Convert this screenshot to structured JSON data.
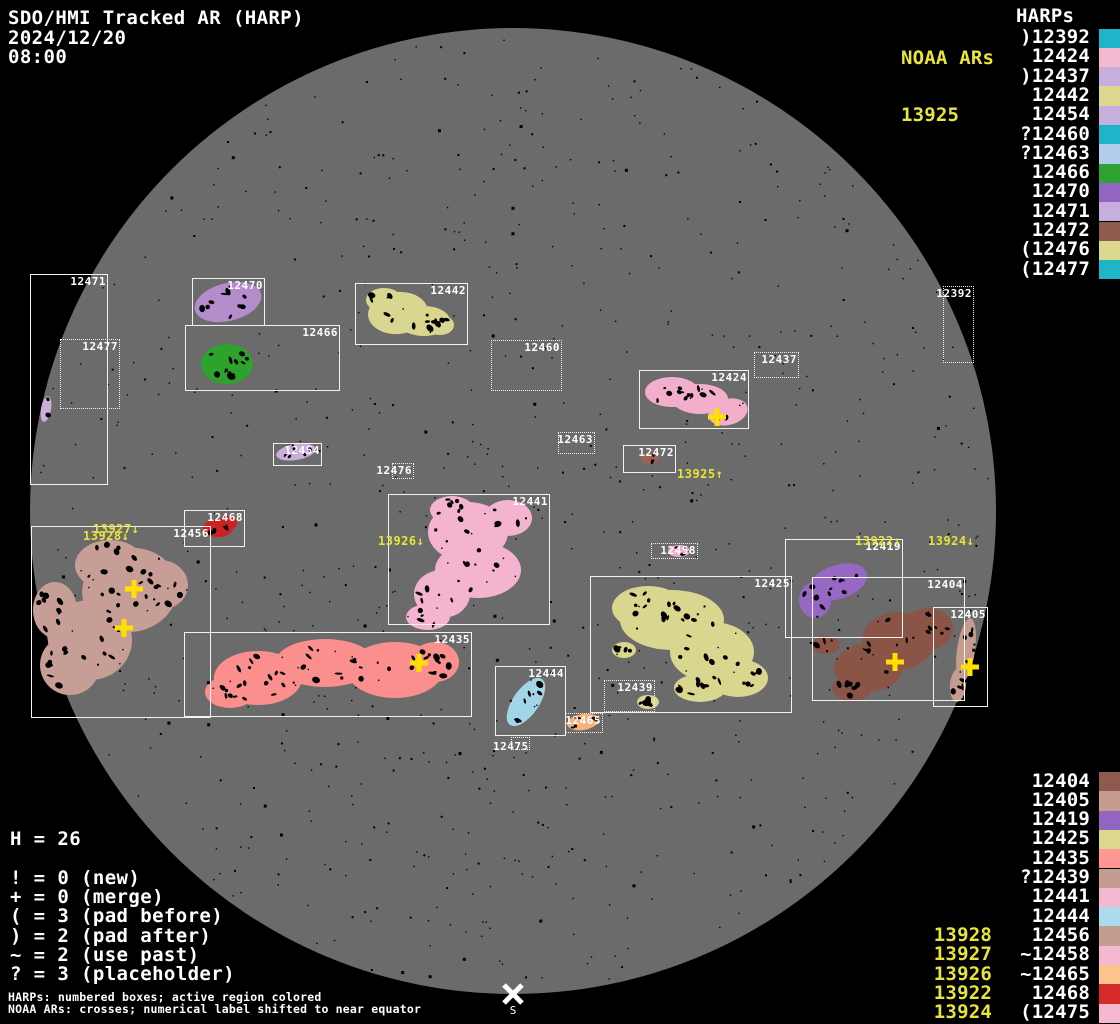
{
  "header": {
    "title": "SDO/HMI Tracked AR (HARP)",
    "date": "2024/12/20",
    "time": "08:00"
  },
  "colors": {
    "background": "#000000",
    "disk": "#6b6b6b",
    "box_border": "#f2f2f2",
    "label_white": "#ffffff",
    "noaa_yellow": "#e8e43a",
    "cross_yellow": "#ffe000"
  },
  "noaa_panel": {
    "title": "NOAA ARs",
    "value": "13925"
  },
  "harps_panel": {
    "title": "HARPs",
    "items": [
      {
        "prefix": ")",
        "num": "12392",
        "color": "#1fb5c9"
      },
      {
        "prefix": " ",
        "num": "12424",
        "color": "#f5b8d2"
      },
      {
        "prefix": ")",
        "num": "12437",
        "color": "#c6aedd"
      },
      {
        "prefix": " ",
        "num": "12442",
        "color": "#dcd98e"
      },
      {
        "prefix": " ",
        "num": "12454",
        "color": "#c6aedd"
      },
      {
        "prefix": "?",
        "num": "12460",
        "color": "#1fb5c9"
      },
      {
        "prefix": "?",
        "num": "12463",
        "color": "#b4cdec"
      },
      {
        "prefix": " ",
        "num": "12466",
        "color": "#2fa233"
      },
      {
        "prefix": " ",
        "num": "12470",
        "color": "#9266c0"
      },
      {
        "prefix": " ",
        "num": "12471",
        "color": "#c6aedd"
      },
      {
        "prefix": " ",
        "num": "12472",
        "color": "#8f5a4e"
      },
      {
        "prefix": "(",
        "num": "12476",
        "color": "#dcd98e"
      },
      {
        "prefix": "(",
        "num": "12477",
        "color": "#1fb5c9"
      }
    ]
  },
  "bottom_right_panel": {
    "items": [
      {
        "prefix": " ",
        "num": "12404",
        "color": "#8f5a4e",
        "noaa": ""
      },
      {
        "prefix": " ",
        "num": "12405",
        "color": "#c49c90",
        "noaa": ""
      },
      {
        "prefix": " ",
        "num": "12419",
        "color": "#9266c0",
        "noaa": ""
      },
      {
        "prefix": " ",
        "num": "12425",
        "color": "#dcd98e",
        "noaa": ""
      },
      {
        "prefix": " ",
        "num": "12435",
        "color": "#ff9694",
        "noaa": ""
      },
      {
        "prefix": "?",
        "num": "12439",
        "color": "#c49c90",
        "noaa": ""
      },
      {
        "prefix": " ",
        "num": "12441",
        "color": "#f5b8d2",
        "noaa": ""
      },
      {
        "prefix": " ",
        "num": "12444",
        "color": "#aadced",
        "noaa": ""
      },
      {
        "prefix": " ",
        "num": "12456",
        "color": "#c49c90",
        "noaa": "13928"
      },
      {
        "prefix": "~",
        "num": "12458",
        "color": "#f5b8d2",
        "noaa": "13927"
      },
      {
        "prefix": "~",
        "num": "12465",
        "color": "#fdc38b",
        "noaa": "13926"
      },
      {
        "prefix": " ",
        "num": "12468",
        "color": "#d42b28",
        "noaa": "13922"
      },
      {
        "prefix": "(",
        "num": "12475",
        "color": "#f5b8d2",
        "noaa": "13924"
      }
    ]
  },
  "stats": {
    "h_line": "H = 26",
    "legend": [
      "! = 0 (new)",
      "+ = 0 (merge)",
      "( = 3 (pad before)",
      ") = 2 (pad after)",
      "~ = 2 (use past)",
      "? = 3 (placeholder)"
    ]
  },
  "footer": {
    "line1": "HARPs: numbered boxes; active region colored",
    "line2": "NOAA ARs: crosses; numerical label shifted to near equator"
  },
  "chart_data": {
    "type": "scatter",
    "title": "SDO/HMI Tracked AR (HARP) full-disk map, 2024/12/20 08:00",
    "disk": {
      "cx": 513,
      "cy": 511,
      "r": 483,
      "color": "#6b6b6b"
    },
    "south_marker": {
      "x": 513,
      "y": 994,
      "label": "S"
    },
    "harp_boxes": [
      {
        "id": "12471",
        "x": 30,
        "y": 274,
        "w": 78,
        "h": 211,
        "style": "solid",
        "anchor": "tr"
      },
      {
        "id": "12477",
        "x": 60,
        "y": 339,
        "w": 60,
        "h": 70,
        "style": "dotted",
        "anchor": "tr"
      },
      {
        "id": "12470",
        "x": 192,
        "y": 278,
        "w": 73,
        "h": 48,
        "style": "solid",
        "anchor": "tr"
      },
      {
        "id": "12466",
        "x": 185,
        "y": 325,
        "w": 155,
        "h": 66,
        "style": "solid",
        "anchor": "tr"
      },
      {
        "id": "12442",
        "x": 355,
        "y": 283,
        "w": 113,
        "h": 62,
        "style": "solid",
        "anchor": "tr"
      },
      {
        "id": "12460",
        "x": 491,
        "y": 340,
        "w": 71,
        "h": 51,
        "style": "dotted",
        "anchor": "tr"
      },
      {
        "id": "12437",
        "x": 754,
        "y": 352,
        "w": 45,
        "h": 26,
        "style": "dotted",
        "anchor": "tr"
      },
      {
        "id": "12424",
        "x": 639,
        "y": 370,
        "w": 110,
        "h": 59,
        "style": "solid",
        "anchor": "tr"
      },
      {
        "id": "12463",
        "x": 558,
        "y": 432,
        "w": 37,
        "h": 22,
        "style": "dotted",
        "anchor": "tr"
      },
      {
        "id": "12454",
        "x": 273,
        "y": 443,
        "w": 49,
        "h": 23,
        "style": "solid",
        "anchor": "tr"
      },
      {
        "id": "12472",
        "x": 623,
        "y": 445,
        "w": 53,
        "h": 28,
        "style": "solid",
        "anchor": "tr"
      },
      {
        "id": "12476",
        "x": 392,
        "y": 463,
        "w": 22,
        "h": 16,
        "style": "dotted",
        "anchor": "tr"
      },
      {
        "id": "12392",
        "x": 943,
        "y": 286,
        "w": 31,
        "h": 77,
        "style": "dotted",
        "anchor": "tr"
      },
      {
        "id": "12441",
        "x": 388,
        "y": 494,
        "w": 162,
        "h": 131,
        "style": "solid",
        "anchor": "tr"
      },
      {
        "id": "12456",
        "x": 31,
        "y": 526,
        "w": 180,
        "h": 192,
        "style": "solid",
        "anchor": "tr"
      },
      {
        "id": "12468",
        "x": 184,
        "y": 510,
        "w": 61,
        "h": 37,
        "style": "solid",
        "anchor": "tr"
      },
      {
        "id": "12458",
        "x": 651,
        "y": 543,
        "w": 47,
        "h": 16,
        "style": "dotted",
        "anchor": "tr"
      },
      {
        "id": "12419",
        "x": 785,
        "y": 539,
        "w": 118,
        "h": 99,
        "style": "solid",
        "anchor": "tr"
      },
      {
        "id": "12425",
        "x": 590,
        "y": 576,
        "w": 202,
        "h": 137,
        "style": "solid",
        "anchor": "tr"
      },
      {
        "id": "12404",
        "x": 812,
        "y": 577,
        "w": 153,
        "h": 124,
        "style": "solid",
        "anchor": "tr"
      },
      {
        "id": "12405",
        "x": 933,
        "y": 607,
        "w": 55,
        "h": 100,
        "style": "solid",
        "anchor": "tr"
      },
      {
        "id": "12435",
        "x": 184,
        "y": 632,
        "w": 288,
        "h": 85,
        "style": "solid",
        "anchor": "tr"
      },
      {
        "id": "12444",
        "x": 495,
        "y": 666,
        "w": 71,
        "h": 70,
        "style": "solid",
        "anchor": "tr"
      },
      {
        "id": "12439",
        "x": 604,
        "y": 680,
        "w": 51,
        "h": 32,
        "style": "dotted",
        "anchor": "tr"
      },
      {
        "id": "12465",
        "x": 565,
        "y": 713,
        "w": 38,
        "h": 20,
        "style": "dotted",
        "anchor": "tr"
      },
      {
        "id": "12475",
        "x": 511,
        "y": 737,
        "w": 19,
        "h": 13,
        "style": "dotted",
        "anchor": "bl"
      }
    ],
    "regions": [
      {
        "id": "12470",
        "color": "#b38dc9",
        "spots": 10,
        "ellipses": [
          [
            228,
            302,
            34,
            19,
            -14
          ]
        ]
      },
      {
        "id": "12466",
        "color": "#2da22d",
        "spots": 10,
        "ellipses": [
          [
            227,
            364,
            26,
            20,
            0
          ]
        ]
      },
      {
        "id": "12442",
        "color": "#d9d78f",
        "spots": 16,
        "ellipses": [
          [
            398,
            313,
            30,
            21,
            -5
          ],
          [
            424,
            321,
            26,
            15,
            0
          ],
          [
            384,
            300,
            18,
            12,
            0
          ],
          [
            440,
            325,
            14,
            10,
            0
          ]
        ]
      },
      {
        "id": "12424",
        "color": "#f2aecb",
        "spots": 14,
        "ellipses": [
          [
            672,
            392,
            27,
            15,
            0
          ],
          [
            700,
            399,
            28,
            15,
            0
          ],
          [
            728,
            412,
            20,
            13,
            -15
          ]
        ]
      },
      {
        "id": "12454",
        "color": "#c9aeda",
        "spots": 5,
        "ellipses": [
          [
            296,
            452,
            20,
            8,
            -10
          ]
        ]
      },
      {
        "id": "12471",
        "color": "#c9aeda",
        "spots": 2,
        "ellipses": [
          [
            46,
            409,
            5,
            13,
            10
          ]
        ]
      },
      {
        "id": "12472",
        "color": "#9c6454",
        "spots": 3,
        "ellipses": [
          [
            650,
            458,
            9,
            6,
            0
          ]
        ]
      },
      {
        "id": "12441",
        "color": "#f4b3ce",
        "spots": 30,
        "ellipses": [
          [
            468,
            532,
            40,
            30,
            0
          ],
          [
            478,
            570,
            43,
            28,
            0
          ],
          [
            442,
            594,
            28,
            24,
            0
          ],
          [
            428,
            617,
            22,
            13,
            0
          ],
          [
            508,
            518,
            24,
            18,
            0
          ],
          [
            452,
            510,
            22,
            14,
            0
          ]
        ]
      },
      {
        "id": "12456",
        "color": "#c79e95",
        "spots": 46,
        "ellipses": [
          [
            130,
            590,
            48,
            42,
            -10
          ],
          [
            90,
            640,
            42,
            40,
            0
          ],
          [
            70,
            665,
            30,
            30,
            0
          ],
          [
            110,
            565,
            35,
            25,
            0
          ],
          [
            160,
            585,
            28,
            25,
            0
          ],
          [
            55,
            610,
            22,
            28,
            0
          ]
        ]
      },
      {
        "id": "12468",
        "color": "#cc2222",
        "spots": 4,
        "ellipses": [
          [
            218,
            528,
            15,
            9,
            0
          ],
          [
            228,
            523,
            9,
            7,
            0
          ]
        ]
      },
      {
        "id": "12435",
        "color": "#fb8f8d",
        "spots": 42,
        "ellipses": [
          [
            258,
            678,
            44,
            27,
            0
          ],
          [
            325,
            663,
            50,
            24,
            0
          ],
          [
            395,
            670,
            48,
            28,
            0
          ],
          [
            435,
            662,
            24,
            20,
            0
          ],
          [
            230,
            692,
            25,
            16,
            0
          ]
        ]
      },
      {
        "id": "12444",
        "color": "#a3d5e8",
        "spots": 7,
        "ellipses": [
          [
            526,
            702,
            28,
            13,
            -55
          ]
        ]
      },
      {
        "id": "12465",
        "color": "#f7b27a",
        "spots": 4,
        "ellipses": [
          [
            583,
            722,
            16,
            8,
            -10
          ]
        ]
      },
      {
        "id": "12425",
        "color": "#d9d78f",
        "spots": 46,
        "ellipses": [
          [
            672,
            620,
            52,
            30,
            0
          ],
          [
            712,
            652,
            42,
            30,
            0
          ],
          [
            648,
            608,
            36,
            22,
            0
          ],
          [
            738,
            678,
            30,
            19,
            0
          ],
          [
            700,
            688,
            26,
            14,
            0
          ],
          [
            624,
            650,
            12,
            8,
            0
          ],
          [
            648,
            702,
            11,
            7,
            0
          ]
        ]
      },
      {
        "id": "12419",
        "color": "#9668c4",
        "spots": 10,
        "ellipses": [
          [
            838,
            582,
            30,
            17,
            -18
          ],
          [
            815,
            600,
            16,
            18,
            0
          ]
        ]
      },
      {
        "id": "12404",
        "color": "#8a5546",
        "spots": 24,
        "ellipses": [
          [
            898,
            641,
            36,
            29,
            0
          ],
          [
            868,
            668,
            34,
            24,
            0
          ],
          [
            928,
            629,
            25,
            21,
            0
          ],
          [
            852,
            688,
            20,
            13,
            0
          ],
          [
            826,
            645,
            14,
            9,
            0
          ]
        ]
      },
      {
        "id": "12405",
        "color": "#c49c90",
        "spots": 8,
        "ellipses": [
          [
            966,
            650,
            9,
            32,
            8
          ],
          [
            958,
            685,
            8,
            17,
            5
          ]
        ]
      },
      {
        "id": "12458",
        "color": "#f2aecb",
        "spots": 2,
        "ellipses": [
          [
            679,
            551,
            11,
            6,
            0
          ]
        ]
      }
    ],
    "noaa_crosses": [
      {
        "id": "13925",
        "x": 717,
        "y": 417
      },
      {
        "id": "13927",
        "x": 134,
        "y": 589
      },
      {
        "id": "13928",
        "x": 124,
        "y": 628
      },
      {
        "id": "13926",
        "x": 419,
        "y": 663
      },
      {
        "id": "13922",
        "x": 895,
        "y": 662
      },
      {
        "id": "13924",
        "x": 970,
        "y": 667
      }
    ],
    "noaa_disk_labels": [
      {
        "text": "13925↑",
        "x": 677,
        "y": 468
      },
      {
        "text": "13927↓",
        "x": 93,
        "y": 523
      },
      {
        "text": "13928↓",
        "x": 83,
        "y": 530
      },
      {
        "text": "13926↓",
        "x": 378,
        "y": 535
      },
      {
        "text": "13922↓",
        "x": 855,
        "y": 535
      },
      {
        "text": "13924↓",
        "x": 928,
        "y": 535
      }
    ]
  }
}
